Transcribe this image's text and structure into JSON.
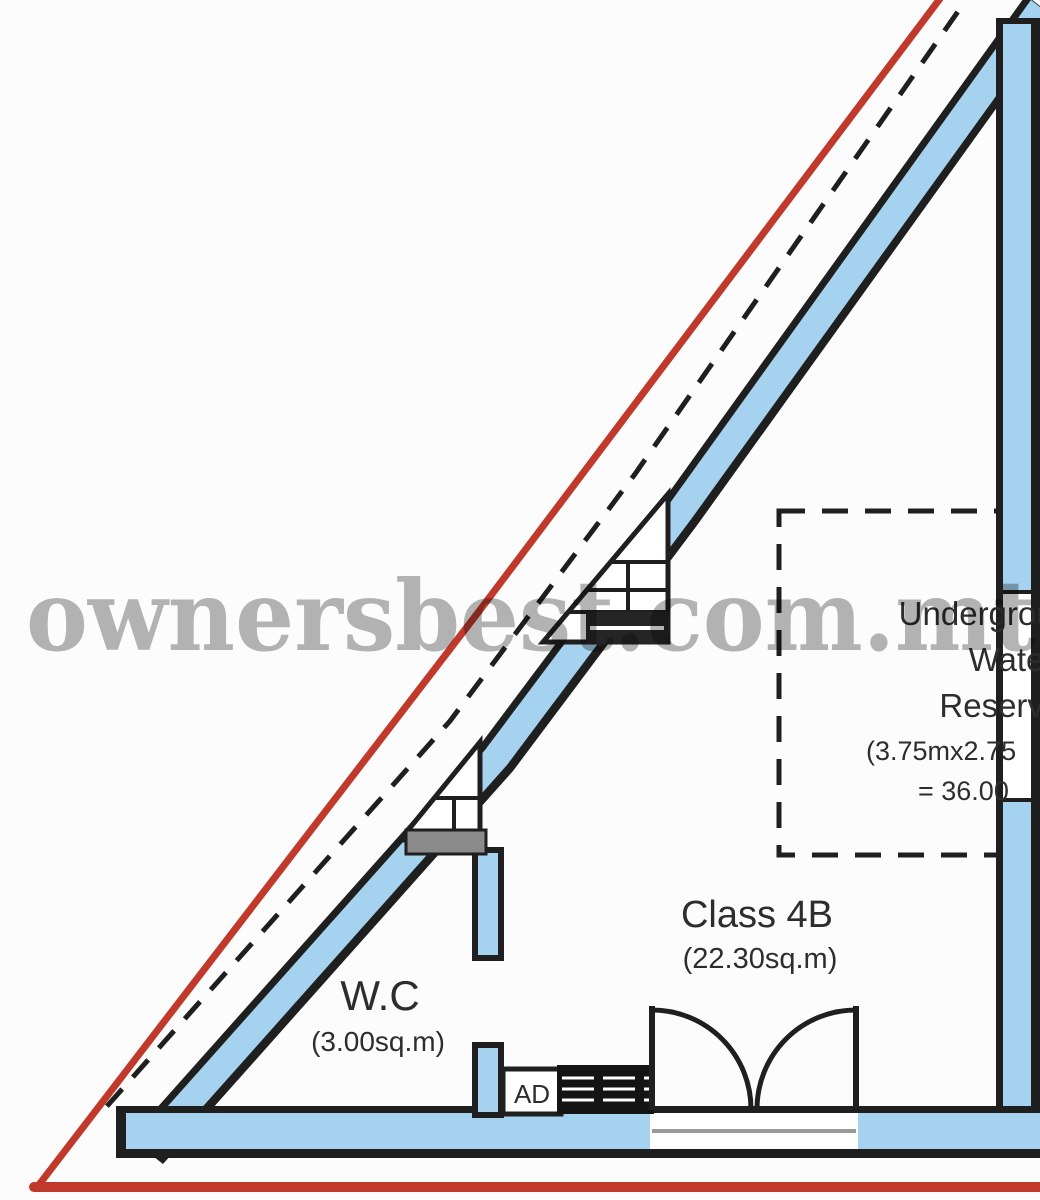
{
  "plan": {
    "title": "floor-plan",
    "watermark": "ownersbest.com.mt",
    "rooms": {
      "wc": {
        "name": "W.C",
        "area": "(3.00sq.m)"
      },
      "class4b": {
        "name": "Class 4B",
        "area": "(22.30sq.m)"
      },
      "reservoir": {
        "line1": "Underground",
        "line2": "Water",
        "line3": "Reservoir",
        "dims": "(3.75mx2.75",
        "volume": "= 36.00"
      }
    },
    "fixtures": {
      "ad_label": "AD"
    },
    "colors": {
      "wall_blue": "#a5d2ee",
      "line_black": "#1f1f1f",
      "boundary_red": "#c0392b",
      "sill_gray": "#8a8a8a",
      "watermark_gray": "#a3a3a3",
      "text_dark": "#2d2d2d",
      "threshold_gray": "#9a9a9a"
    }
  }
}
